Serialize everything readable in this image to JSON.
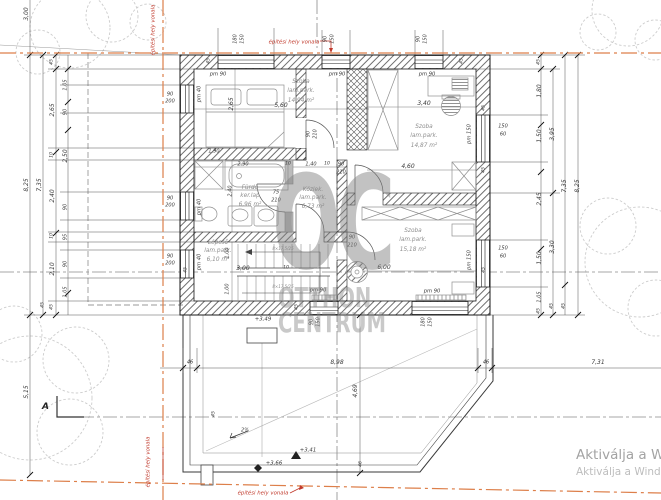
{
  "watermark": {
    "line1": "OC",
    "line2": "OTTHON",
    "line3": "CENTRUM"
  },
  "activation": {
    "line1": "Aktiválja a W",
    "line2": "Aktiválja a Wind"
  },
  "section": {
    "label": "A"
  },
  "rooms": [
    {
      "name": "Szoba",
      "finish": "lam.park.",
      "area": "14,94 m²"
    },
    {
      "name": "Szoba",
      "finish": "lam.park.",
      "area": "14,87 m²"
    },
    {
      "name": "Szoba",
      "finish": "lam.park.",
      "area": "15,18 m²"
    },
    {
      "name": "Fürdő",
      "finish": "ker.lap",
      "area": "6,96 m²"
    },
    {
      "name": "Közlek.",
      "finish": "lam.park.",
      "area": "6,73 m²"
    },
    {
      "name": "Lépcső",
      "finish": "lam.park.",
      "area": "6,10 m²"
    }
  ],
  "dim_labels": [
    {
      "t": "3,00",
      "x": 27,
      "y": 14,
      "r": -90
    },
    {
      "t": "180",
      "x": 236,
      "y": 39,
      "r": -90,
      "s": 5
    },
    {
      "t": "150",
      "x": 243,
      "y": 39,
      "r": -90,
      "s": 5
    },
    {
      "t": "90",
      "x": 326,
      "y": 39,
      "r": -90,
      "s": 5
    },
    {
      "t": "150",
      "x": 333,
      "y": 39,
      "r": -90,
      "s": 5
    },
    {
      "t": "90",
      "x": 419,
      "y": 39,
      "r": -90,
      "s": 5
    },
    {
      "t": "150",
      "x": 426,
      "y": 39,
      "r": -90,
      "s": 5
    },
    {
      "t": "45",
      "x": 210,
      "y": 61,
      "r": -90,
      "s": 4.6
    },
    {
      "t": "45",
      "x": 463,
      "y": 61,
      "r": -90,
      "s": 4.6
    },
    {
      "t": "pm 90",
      "x": 218,
      "y": 75,
      "s": 5.2
    },
    {
      "t": "pm 90",
      "x": 337,
      "y": 75,
      "s": 5.2
    },
    {
      "t": "pm 90",
      "x": 427,
      "y": 75,
      "s": 5.2
    },
    {
      "t": "pm 40",
      "x": 200,
      "y": 94,
      "r": -90,
      "s": 5.2
    },
    {
      "t": "pm 40",
      "x": 200,
      "y": 207,
      "r": -90,
      "s": 5.2
    },
    {
      "t": "pm 40",
      "x": 200,
      "y": 262,
      "r": -90,
      "s": 5.2
    },
    {
      "t": "pm 150",
      "x": 470,
      "y": 134,
      "r": -90,
      "s": 5.2
    },
    {
      "t": "pm 150",
      "x": 470,
      "y": 260,
      "r": -90,
      "s": 5.2
    },
    {
      "t": "pm 90",
      "x": 318,
      "y": 291,
      "s": 5.2
    },
    {
      "t": "pm 90",
      "x": 432,
      "y": 292,
      "s": 5.2
    },
    {
      "t": "90",
      "x": 170,
      "y": 95,
      "s": 5
    },
    {
      "t": "200",
      "x": 170,
      "y": 102,
      "s": 5
    },
    {
      "t": "90",
      "x": 170,
      "y": 199,
      "s": 5
    },
    {
      "t": "200",
      "x": 170,
      "y": 206,
      "s": 5
    },
    {
      "t": "90",
      "x": 170,
      "y": 257,
      "s": 5
    },
    {
      "t": "200",
      "x": 170,
      "y": 264,
      "s": 5
    },
    {
      "t": "150",
      "x": 503,
      "y": 127,
      "s": 5
    },
    {
      "t": "60",
      "x": 503,
      "y": 135,
      "s": 5
    },
    {
      "t": "150",
      "x": 503,
      "y": 249,
      "s": 5
    },
    {
      "t": "60",
      "x": 503,
      "y": 257,
      "s": 5
    },
    {
      "t": "45",
      "x": 485,
      "y": 108,
      "r": -90,
      "s": 4.6
    },
    {
      "t": "45",
      "x": 485,
      "y": 170,
      "r": -90,
      "s": 4.6
    },
    {
      "t": "45",
      "x": 485,
      "y": 270,
      "r": -90,
      "s": 4.6
    },
    {
      "t": "90",
      "x": 312,
      "y": 322,
      "r": -90,
      "s": 5
    },
    {
      "t": "150",
      "x": 319,
      "y": 322,
      "r": -90,
      "s": 5
    },
    {
      "t": "180",
      "x": 424,
      "y": 322,
      "r": -90,
      "s": 5
    },
    {
      "t": "150",
      "x": 431,
      "y": 322,
      "r": -90,
      "s": 5
    },
    {
      "t": "8,25",
      "x": 27,
      "y": 185,
      "r": -90
    },
    {
      "t": "7,35",
      "x": 40,
      "y": 185,
      "r": -90
    },
    {
      "t": "45",
      "x": 53,
      "y": 62,
      "r": -90,
      "s": 4.6
    },
    {
      "t": "2,65",
      "x": 53,
      "y": 110,
      "r": -90
    },
    {
      "t": "10",
      "x": 53,
      "y": 155,
      "r": -90,
      "s": 4.6
    },
    {
      "t": "2,40",
      "x": 53,
      "y": 196,
      "r": -90
    },
    {
      "t": "10",
      "x": 53,
      "y": 236,
      "r": -90,
      "s": 4.6
    },
    {
      "t": "2,10",
      "x": 53,
      "y": 269,
      "r": -90
    },
    {
      "t": "45",
      "x": 53,
      "y": 307,
      "r": -90,
      "s": 4.6
    },
    {
      "t": "1,05",
      "x": 66,
      "y": 85,
      "r": -90,
      "s": 5
    },
    {
      "t": "90",
      "x": 66,
      "y": 112,
      "r": -90,
      "s": 5
    },
    {
      "t": "2,50",
      "x": 66,
      "y": 156,
      "r": -90
    },
    {
      "t": "90",
      "x": 66,
      "y": 207,
      "r": -90,
      "s": 5
    },
    {
      "t": "95",
      "x": 66,
      "y": 237,
      "r": -90,
      "s": 5
    },
    {
      "t": "90",
      "x": 66,
      "y": 264,
      "r": -90,
      "s": 5
    },
    {
      "t": "1,05",
      "x": 66,
      "y": 292,
      "r": -90,
      "s": 5
    },
    {
      "t": "45",
      "x": 44,
      "y": 305,
      "r": -90,
      "s": 4.6
    },
    {
      "t": "5,15",
      "x": 27,
      "y": 392,
      "r": -90
    },
    {
      "t": "45",
      "x": 540,
      "y": 62,
      "r": -90,
      "s": 4.6
    },
    {
      "t": "1,80",
      "x": 540,
      "y": 91,
      "r": -90
    },
    {
      "t": "1,50",
      "x": 540,
      "y": 136,
      "r": -90
    },
    {
      "t": "2,45",
      "x": 540,
      "y": 199,
      "r": -90
    },
    {
      "t": "1,50",
      "x": 540,
      "y": 258,
      "r": -90
    },
    {
      "t": "1,05",
      "x": 540,
      "y": 297,
      "r": -90,
      "s": 5
    },
    {
      "t": "45",
      "x": 540,
      "y": 311,
      "r": -90,
      "s": 4.6
    },
    {
      "t": "3,95",
      "x": 553,
      "y": 134,
      "r": -90
    },
    {
      "t": "3,30",
      "x": 553,
      "y": 247,
      "r": -90
    },
    {
      "t": "45",
      "x": 553,
      "y": 306,
      "r": -90,
      "s": 4.6
    },
    {
      "t": "7,35",
      "x": 565,
      "y": 186,
      "r": -90
    },
    {
      "t": "45",
      "x": 565,
      "y": 306,
      "r": -90,
      "s": 4.6
    },
    {
      "t": "8,25",
      "x": 578,
      "y": 186,
      "r": -90
    },
    {
      "t": "5,60",
      "x": 281,
      "y": 106
    },
    {
      "t": "2,65",
      "x": 232,
      "y": 104,
      "r": -90
    },
    {
      "t": "1,90",
      "x": 214,
      "y": 152,
      "s": 5
    },
    {
      "t": "3,40",
      "x": 424,
      "y": 104
    },
    {
      "t": "4,60",
      "x": 408,
      "y": 167
    },
    {
      "t": "2,90",
      "x": 243,
      "y": 165,
      "s": 5
    },
    {
      "t": "10",
      "x": 288,
      "y": 165,
      "s": 4.6
    },
    {
      "t": "1,40",
      "x": 311,
      "y": 165,
      "s": 5
    },
    {
      "t": "10",
      "x": 327,
      "y": 165,
      "s": 4.6
    },
    {
      "t": "90",
      "x": 341,
      "y": 165,
      "s": 5
    },
    {
      "t": "210",
      "x": 341,
      "y": 173,
      "s": 5
    },
    {
      "t": "75",
      "x": 276,
      "y": 193,
      "s": 5
    },
    {
      "t": "210",
      "x": 276,
      "y": 201,
      "s": 5
    },
    {
      "t": "90",
      "x": 309,
      "y": 134,
      "r": -90,
      "s": 5
    },
    {
      "t": "210",
      "x": 316,
      "y": 134,
      "r": -90,
      "s": 5
    },
    {
      "t": "2,40",
      "x": 231,
      "y": 191,
      "r": -90,
      "s": 5
    },
    {
      "t": "90",
      "x": 352,
      "y": 238,
      "s": 5
    },
    {
      "t": "210",
      "x": 352,
      "y": 246,
      "s": 5
    },
    {
      "t": "3,00",
      "x": 243,
      "y": 269
    },
    {
      "t": "10",
      "x": 286,
      "y": 269,
      "s": 4.6
    },
    {
      "t": "1,00",
      "x": 228,
      "y": 253,
      "r": -90,
      "s": 5
    },
    {
      "t": "1,00",
      "x": 228,
      "y": 289,
      "r": -90,
      "s": 5
    },
    {
      "t": "6,00",
      "x": 384,
      "y": 268
    },
    {
      "t": "8×17,5/25",
      "x": 283,
      "y": 249,
      "s": 4,
      "c": "tiny"
    },
    {
      "t": "8×17,5/25",
      "x": 283,
      "y": 287,
      "s": 4,
      "c": "tiny"
    },
    {
      "t": "45",
      "x": 298,
      "y": 307,
      "r": -90,
      "s": 4.6
    },
    {
      "t": "45",
      "x": 187,
      "y": 270,
      "r": -90,
      "s": 4.6
    },
    {
      "t": "46",
      "x": 190,
      "y": 363,
      "s": 5
    },
    {
      "t": "8,98",
      "x": 337,
      "y": 363
    },
    {
      "t": "46",
      "x": 486,
      "y": 363,
      "s": 5
    },
    {
      "t": "7,31",
      "x": 598,
      "y": 363
    },
    {
      "t": "4,69",
      "x": 356,
      "y": 391,
      "r": -90
    },
    {
      "t": "+3,49",
      "x": 263,
      "y": 320,
      "s": 5.4
    },
    {
      "t": "+3,41",
      "x": 308,
      "y": 451,
      "s": 5.4
    },
    {
      "t": "+3,66",
      "x": 274,
      "y": 464,
      "s": 5.4
    },
    {
      "t": "2%",
      "x": 245,
      "y": 431,
      "s": 5
    },
    {
      "t": "45",
      "x": 215,
      "y": 414,
      "r": -90,
      "s": 4.6
    },
    {
      "t": "46",
      "x": 362,
      "y": 464,
      "r": -90,
      "s": 4.6
    },
    {
      "t": "építési hely vonala",
      "x": 154,
      "y": 30,
      "r": -90,
      "c": "red",
      "s": 5.4
    },
    {
      "t": "építési hely vonala",
      "x": 294,
      "y": 43,
      "c": "red",
      "s": 5.4
    },
    {
      "t": "építési hely vonala",
      "x": 149,
      "y": 462,
      "r": -90,
      "c": "red",
      "s": 5.4
    },
    {
      "t": "építési hely vonala",
      "x": 263,
      "y": 494,
      "c": "red",
      "s": 5.4
    }
  ]
}
